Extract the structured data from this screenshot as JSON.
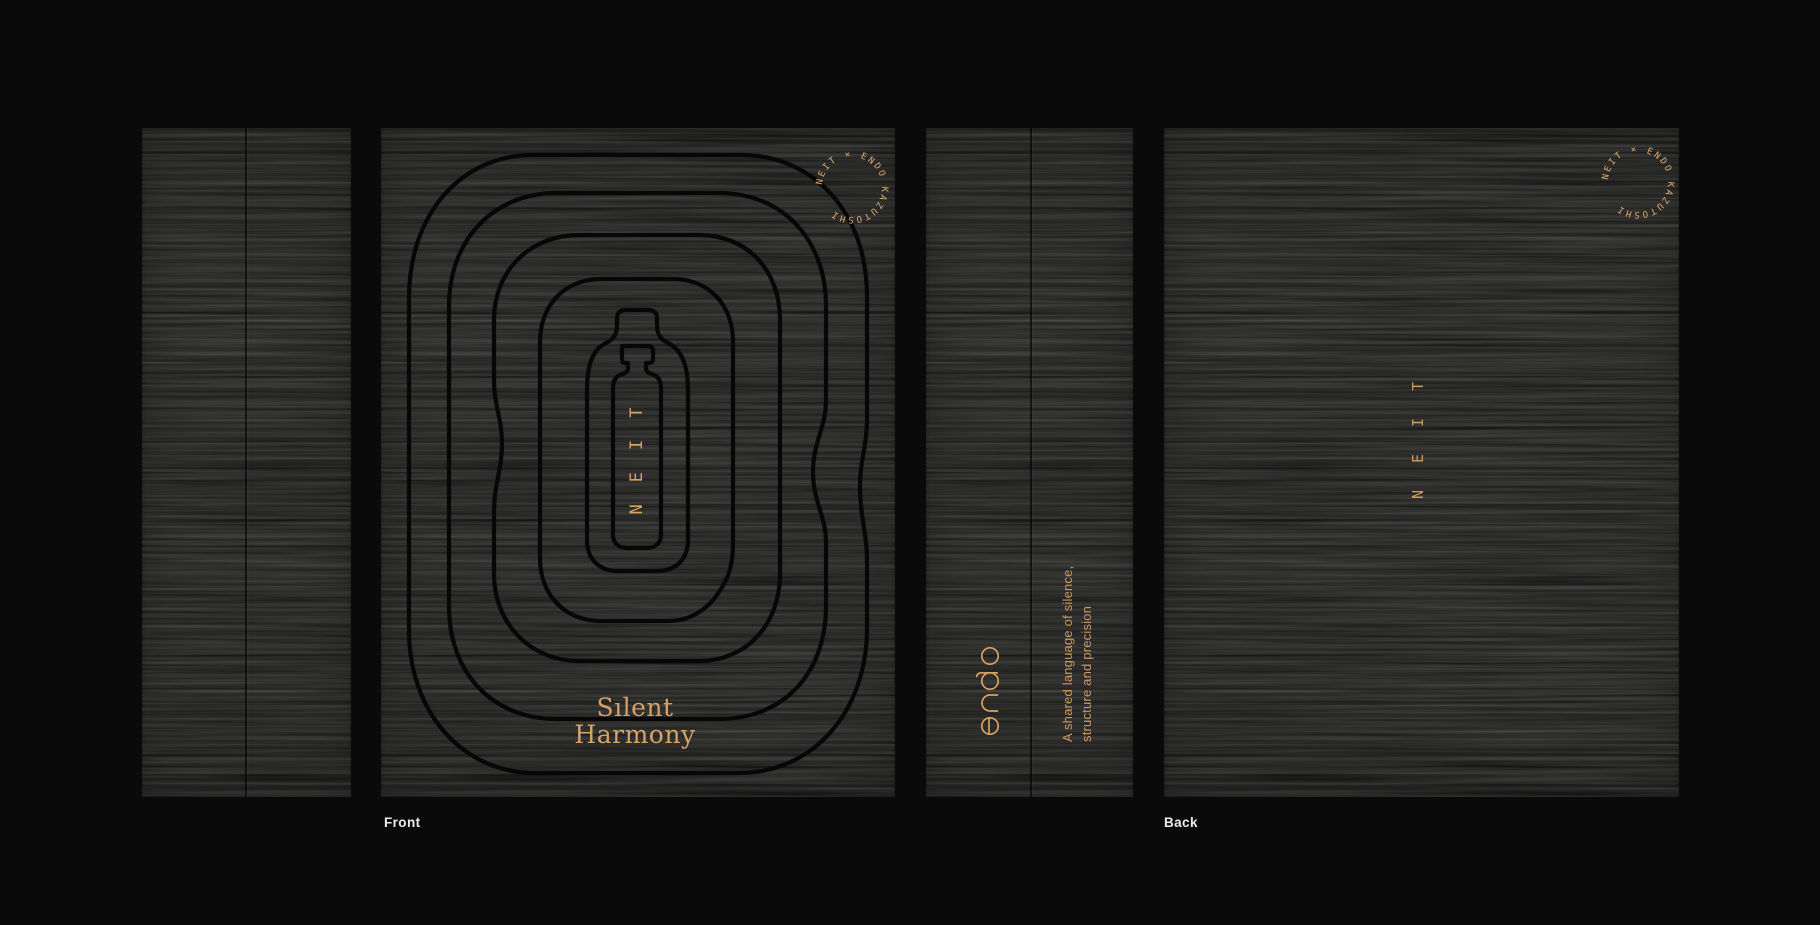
{
  "captions": {
    "front": "Front",
    "back": "Back"
  },
  "front_panel": {
    "badge_text": "NEIT × ENDO KAZUTOSHI",
    "bottle_wordmark": "NEIT",
    "title_line1": "Sılent",
    "title_line2": "Harmony"
  },
  "spine_panel": {
    "logo_name": "endo",
    "tagline_line1": "A shared language of silence,",
    "tagline_line2": "structure and precision"
  },
  "back_panel": {
    "badge_text": "NEIT × ENDO KAZUTOSHI",
    "wordmark": "NEIT"
  },
  "colors": {
    "background": "#0a0a0b",
    "wood_base": "#262625",
    "gold_accent": "#d8a263",
    "contour_line": "#070707",
    "caption_text": "#edecea"
  }
}
